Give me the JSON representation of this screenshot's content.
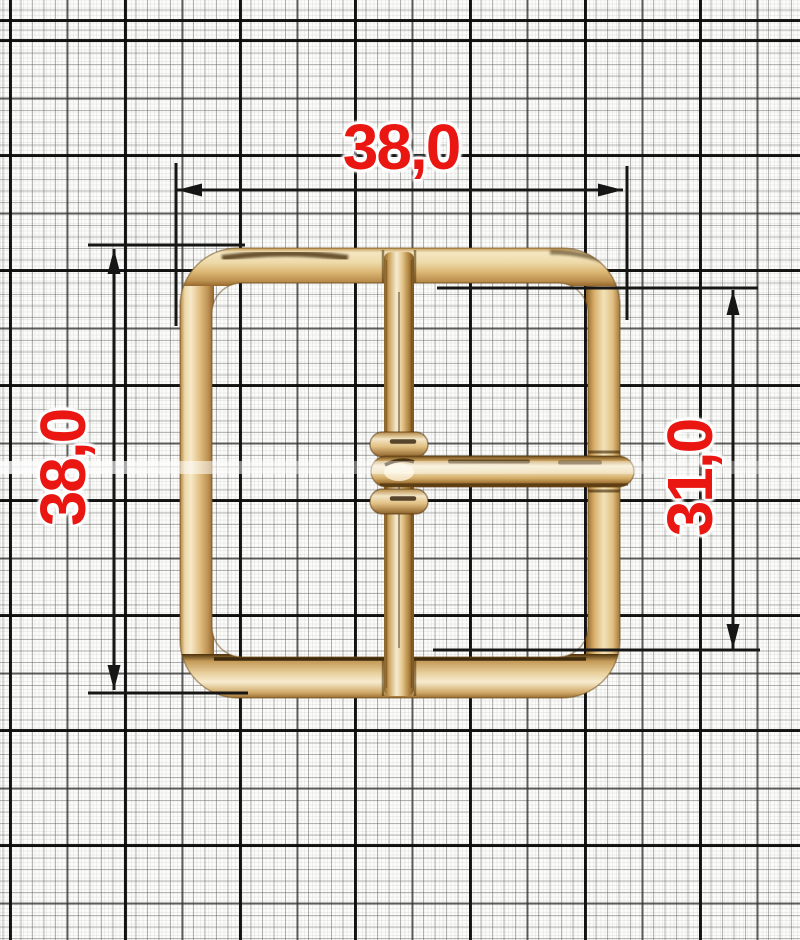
{
  "drawing": {
    "subject": "square belt buckle with center bar and prong",
    "labels": {
      "outer_width": "38,0",
      "outer_height": "38,0",
      "inner_height": "31,0"
    },
    "palette": {
      "dimension_text_red": "#e91612",
      "dimension_line_black": "#161616",
      "metal_gold_base": "#ddbb7e",
      "metal_gold_highlight": "#f8eed4",
      "metal_gold_shadow": "#9a6f30",
      "paper_background": "#fcfcfa"
    }
  }
}
